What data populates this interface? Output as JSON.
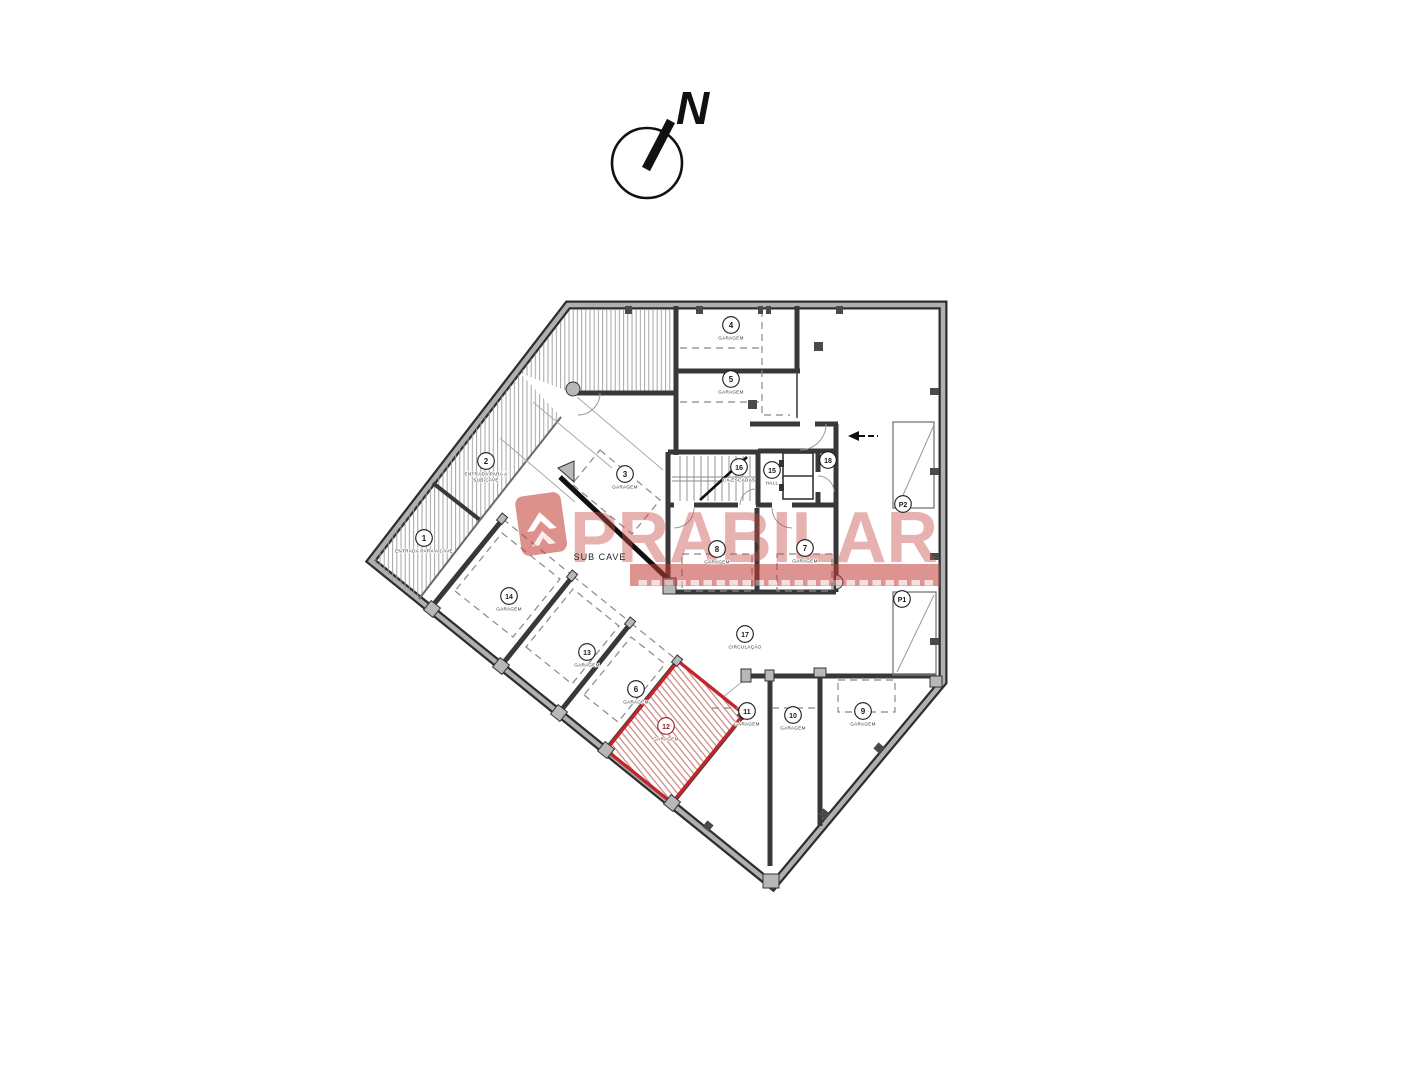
{
  "north": {
    "label": "N"
  },
  "watermark": {
    "brand": "PRABILAR"
  },
  "plan": {
    "area_label": "SUB CAVE",
    "highlight_color": "#c0272d",
    "highlight_label_color": "#8b2424",
    "rooms": [
      {
        "number": "1",
        "name_lines": [
          "ENTRADA PARA A CAVE"
        ],
        "x": 424,
        "y": 538
      },
      {
        "number": "2",
        "name_lines": [
          "ENTRADA PARA A",
          "SUB-CAVE"
        ],
        "x": 486,
        "y": 461
      },
      {
        "number": "3",
        "name_lines": [
          "GARAGEM"
        ],
        "x": 625,
        "y": 474
      },
      {
        "number": "4",
        "name_lines": [
          "GARAGEM"
        ],
        "x": 731,
        "y": 325
      },
      {
        "number": "5",
        "name_lines": [
          "GARAGEM"
        ],
        "x": 731,
        "y": 379
      },
      {
        "number": "6",
        "name_lines": [
          "GARAGEM"
        ],
        "x": 636,
        "y": 689
      },
      {
        "number": "7",
        "name_lines": [
          "GARAGEM"
        ],
        "x": 805,
        "y": 548
      },
      {
        "number": "8",
        "name_lines": [
          "GARAGEM"
        ],
        "x": 717,
        "y": 549
      },
      {
        "number": "9",
        "name_lines": [
          "GARAGEM"
        ],
        "x": 863,
        "y": 711
      },
      {
        "number": "10",
        "name_lines": [
          "GARAGEM"
        ],
        "x": 793,
        "y": 715
      },
      {
        "number": "11",
        "name_lines": [
          "GARAGEM"
        ],
        "x": 747,
        "y": 711
      },
      {
        "number": "12",
        "name_lines": [
          "GARAGEM"
        ],
        "x": 666,
        "y": 726,
        "highlight": true
      },
      {
        "number": "13",
        "name_lines": [
          "GARAGEM"
        ],
        "x": 587,
        "y": 652
      },
      {
        "number": "14",
        "name_lines": [
          "GARAGEM"
        ],
        "x": 509,
        "y": 596
      },
      {
        "number": "15",
        "name_lines": [
          "HALL"
        ],
        "x": 772,
        "y": 470
      },
      {
        "number": "16",
        "name_lines": [
          "CX ESCADAS"
        ],
        "x": 739,
        "y": 467
      },
      {
        "number": "17",
        "name_lines": [
          "CIRCULAÇÃO"
        ],
        "x": 745,
        "y": 634
      },
      {
        "number": "18",
        "name_lines": [],
        "x": 828,
        "y": 460
      },
      {
        "number": "P2",
        "name_lines": [],
        "x": 903,
        "y": 504
      },
      {
        "number": "P1",
        "name_lines": [],
        "x": 902,
        "y": 599
      }
    ]
  }
}
